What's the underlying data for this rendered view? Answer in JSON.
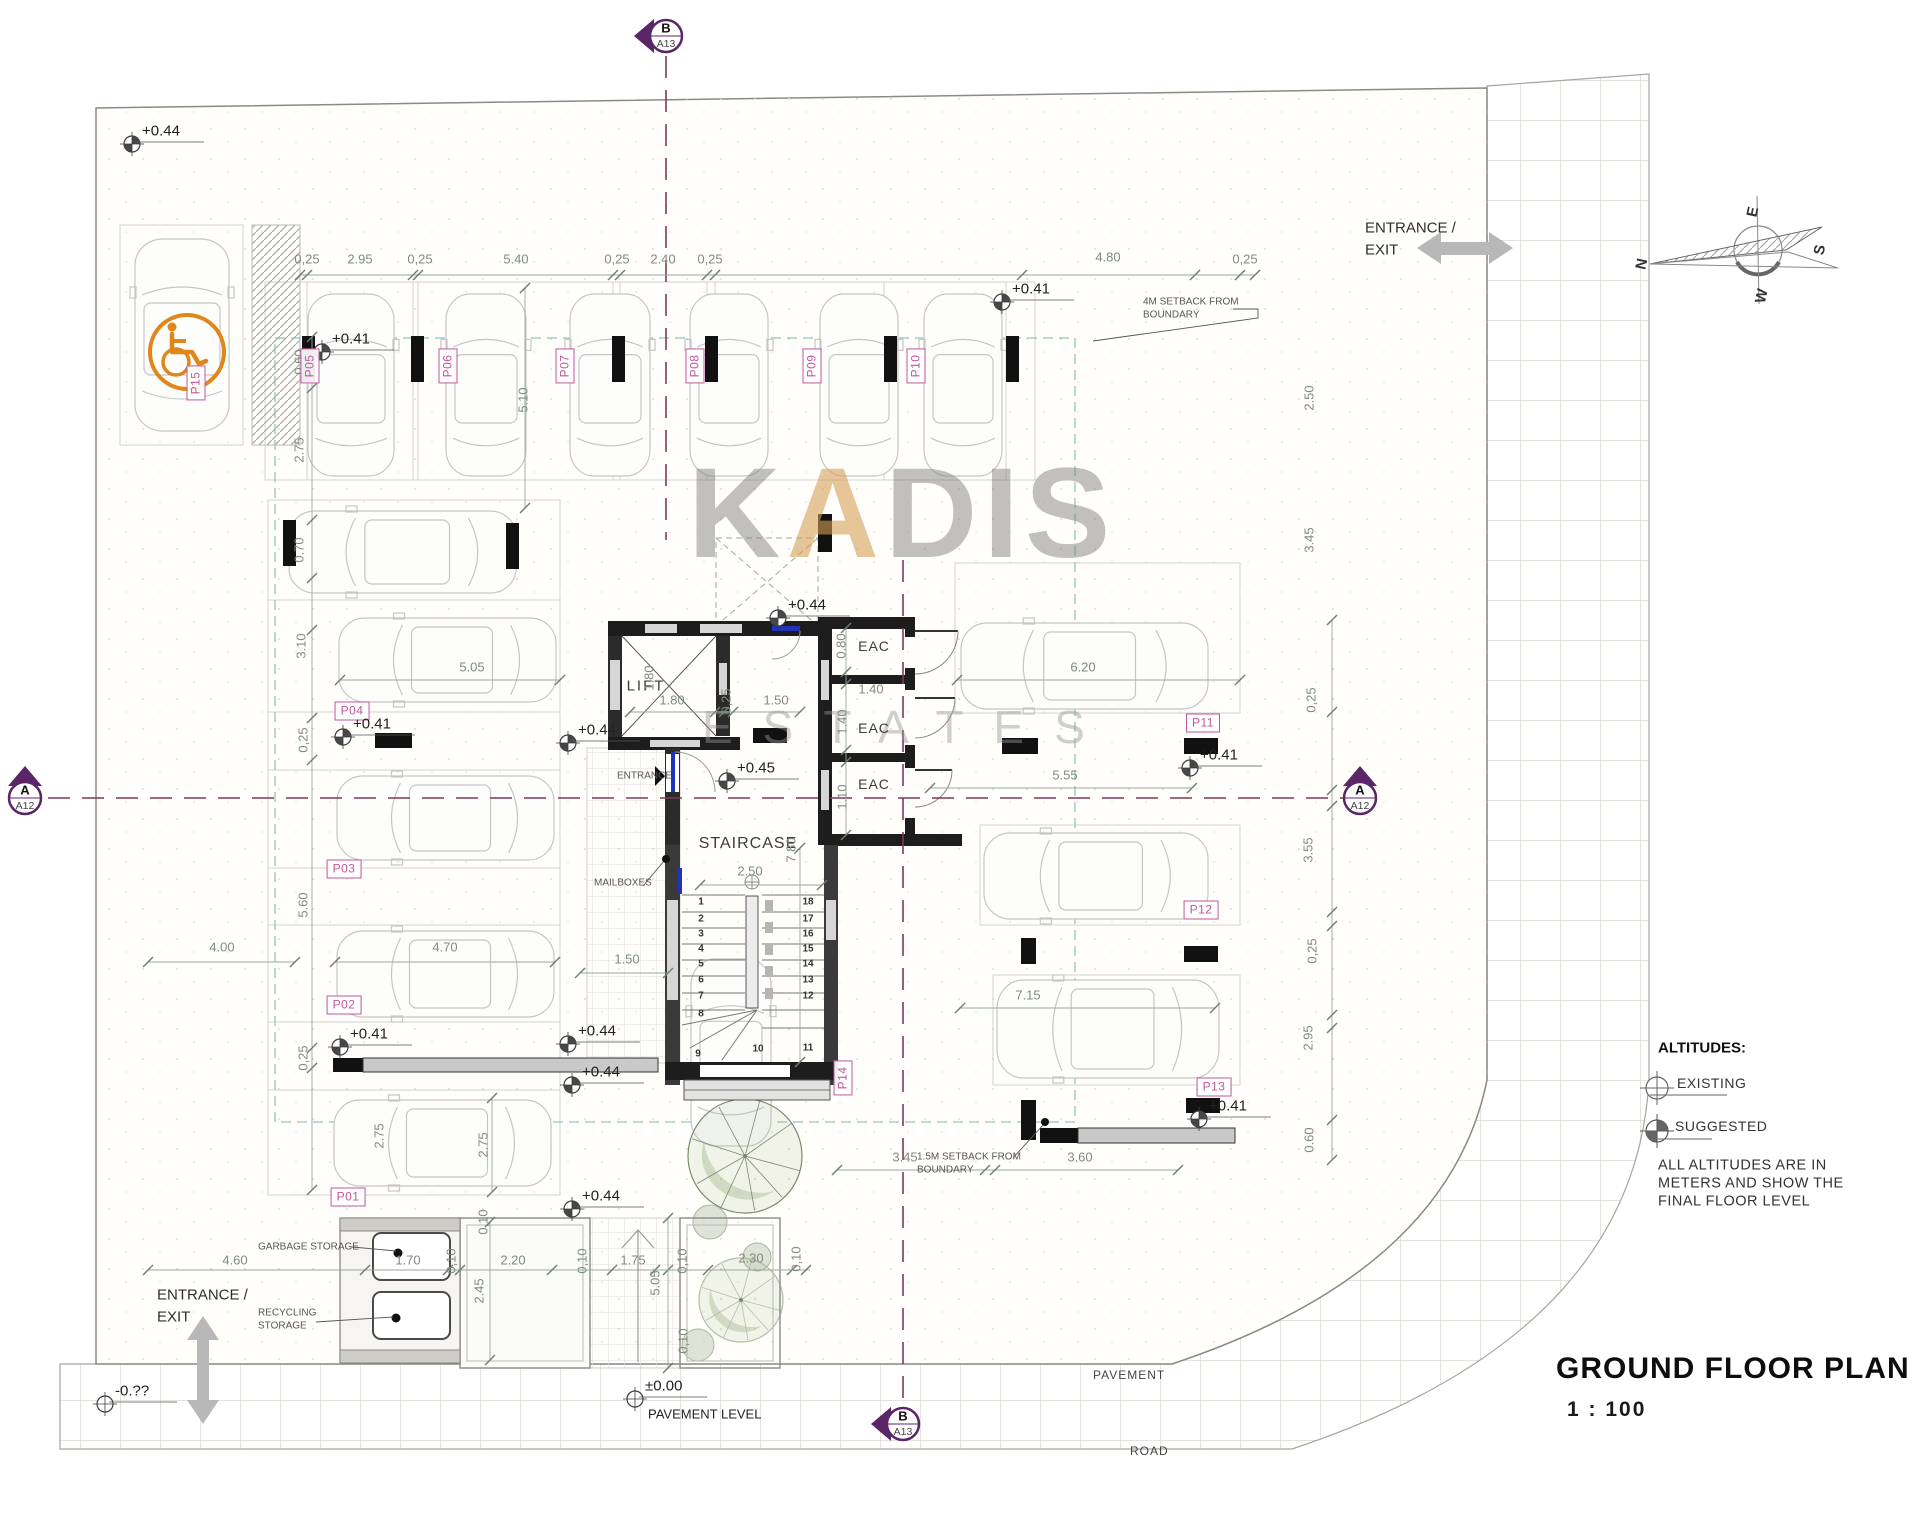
{
  "title": {
    "name": "GROUND FLOOR PLAN",
    "scale": "1 : 100"
  },
  "watermark": {
    "part1": "K",
    "part2": "A",
    "part3": "DIS",
    "line2": "ESTATES"
  },
  "compass": {
    "n": "N",
    "e": "E",
    "s": "S",
    "w": "W"
  },
  "legend": {
    "heading": "ALTITUDES:",
    "existing": "EXISTING",
    "suggested": "SUGGESTED",
    "note": [
      "ALL ALTITUDES ARE IN",
      "METERS AND SHOW THE",
      "FINAL FLOOR LEVEL"
    ]
  },
  "pavement_level_label": "PAVEMENT LEVEL",
  "section_markers": [
    {
      "top": "B",
      "bottom": "A13",
      "x": 666,
      "y": 36,
      "dir": "left"
    },
    {
      "top": "B",
      "bottom": "A13",
      "x": 903,
      "y": 1424,
      "dir": "left"
    },
    {
      "top": "A",
      "bottom": "A12",
      "x": 25,
      "y": 798,
      "dir": "up"
    },
    {
      "top": "A",
      "bottom": "A12",
      "x": 1360,
      "y": 798,
      "dir": "up"
    }
  ],
  "texts": [
    {
      "t": "LIFT",
      "x": 646,
      "y": 686,
      "s": 15,
      "ls": 2
    },
    {
      "t": "STAIRCASE",
      "x": 748,
      "y": 844,
      "s": 16,
      "ls": 1
    },
    {
      "t": "EAC",
      "x": 874,
      "y": 646,
      "s": 14,
      "ls": 1
    },
    {
      "t": "EAC",
      "x": 874,
      "y": 728,
      "s": 14,
      "ls": 1
    },
    {
      "t": "EAC",
      "x": 874,
      "y": 784,
      "s": 14,
      "ls": 1
    },
    {
      "t": "ENTRANCE",
      "x": 617,
      "y": 776,
      "s": 10,
      "a": "l",
      "c": "#555"
    },
    {
      "t": "MAILBOXES",
      "x": 594,
      "y": 883,
      "s": 10,
      "a": "l",
      "c": "#555"
    },
    {
      "t": "GARBAGE STORAGE",
      "x": 258,
      "y": 1247,
      "s": 10,
      "a": "l",
      "c": "#555"
    },
    {
      "t": "RECYCLING",
      "x": 258,
      "y": 1313,
      "s": 10,
      "a": "l",
      "c": "#555"
    },
    {
      "t": "STORAGE",
      "x": 258,
      "y": 1326,
      "s": 10,
      "a": "l",
      "c": "#555"
    },
    {
      "t": "4M SETBACK FROM",
      "x": 1143,
      "y": 302,
      "s": 10,
      "a": "l",
      "c": "#555"
    },
    {
      "t": "BOUNDARY",
      "x": 1143,
      "y": 315,
      "s": 10,
      "a": "l",
      "c": "#555"
    },
    {
      "t": "1.5M SETBACK FROM",
      "x": 917,
      "y": 1157,
      "s": 10,
      "a": "l",
      "c": "#555"
    },
    {
      "t": "BOUNDARY",
      "x": 917,
      "y": 1170,
      "s": 10,
      "a": "l",
      "c": "#555"
    },
    {
      "t": "PAVEMENT",
      "x": 1093,
      "y": 1376,
      "s": 12,
      "a": "l",
      "c": "#444",
      "ls": 1
    },
    {
      "t": "ROAD",
      "x": 1130,
      "y": 1452,
      "s": 12,
      "a": "l",
      "c": "#444",
      "ls": 1
    },
    {
      "t": "ENTRANCE /",
      "x": 1365,
      "y": 228,
      "s": 15,
      "a": "l",
      "c": "#2e2e2e"
    },
    {
      "t": "EXIT",
      "x": 1365,
      "y": 250,
      "s": 15,
      "a": "l",
      "c": "#2e2e2e"
    },
    {
      "t": "ENTRANCE /",
      "x": 157,
      "y": 1295,
      "s": 15,
      "a": "l",
      "c": "#2e2e2e"
    },
    {
      "t": "EXIT",
      "x": 157,
      "y": 1317,
      "s": 15,
      "a": "l",
      "c": "#2e2e2e"
    }
  ],
  "dims": [
    [
      "0,25",
      307,
      260,
      0
    ],
    [
      "2.95",
      360,
      260,
      0
    ],
    [
      "0,25",
      420,
      260,
      0
    ],
    [
      "5.40",
      516,
      260,
      0
    ],
    [
      "0,25",
      617,
      260,
      0
    ],
    [
      "2.40",
      663,
      260,
      0
    ],
    [
      "0,25",
      710,
      260,
      0
    ],
    [
      "4.80",
      1108,
      258,
      0
    ],
    [
      "0,25",
      1245,
      260,
      0
    ],
    [
      "0.60",
      300,
      362,
      1
    ],
    [
      "2.75",
      300,
      450,
      1
    ],
    [
      "0.70",
      300,
      550,
      1
    ],
    [
      "3.10",
      302,
      646,
      1
    ],
    [
      "0,25",
      304,
      740,
      1
    ],
    [
      "5.60",
      304,
      905,
      1
    ],
    [
      "0,25",
      304,
      1058,
      1
    ],
    [
      "2.50",
      1310,
      398,
      1
    ],
    [
      "3.45",
      1310,
      540,
      1
    ],
    [
      "0,25",
      1312,
      700,
      1
    ],
    [
      "3.55",
      1309,
      850,
      1
    ],
    [
      "0,25",
      1313,
      951,
      1
    ],
    [
      "2.95",
      1309,
      1038,
      1
    ],
    [
      "0.60",
      1310,
      1140,
      1
    ],
    [
      "4.60",
      235,
      1261,
      0
    ],
    [
      "1.70",
      408,
      1261,
      0
    ],
    [
      "0,10",
      452,
      1261,
      1
    ],
    [
      "2.20",
      513,
      1261,
      0
    ],
    [
      "0,10",
      583,
      1261,
      1
    ],
    [
      "1.75",
      633,
      1261,
      0
    ],
    [
      "0,10",
      683,
      1261,
      1
    ],
    [
      "2.30",
      751,
      1259,
      0
    ],
    [
      "0,10",
      797,
      1259,
      1
    ],
    [
      "5.05",
      472,
      668,
      0
    ],
    [
      "5.10",
      524,
      400,
      1
    ],
    [
      "4.00",
      222,
      948,
      0
    ],
    [
      "4.70",
      445,
      948,
      0
    ],
    [
      "1.50",
      627,
      960,
      0
    ],
    [
      "6.20",
      1083,
      668,
      0
    ],
    [
      "5.55",
      1065,
      776,
      0
    ],
    [
      "7.15",
      1028,
      996,
      0
    ],
    [
      "2.50",
      750,
      872,
      0
    ],
    [
      "1.80",
      672,
      701,
      0
    ],
    [
      "0,25",
      727,
      701,
      1
    ],
    [
      "1.50",
      776,
      701,
      0
    ],
    [
      "1.80",
      650,
      678,
      1
    ],
    [
      "0.80",
      842,
      646,
      1
    ],
    [
      "1.40",
      871,
      690,
      0
    ],
    [
      "1.40",
      843,
      722,
      1
    ],
    [
      "1.10",
      843,
      797,
      1
    ],
    [
      "7.80",
      792,
      850,
      1
    ],
    [
      "2.75",
      484,
      1145,
      1
    ],
    [
      "2.45",
      480,
      1291,
      1
    ],
    [
      "0,10",
      484,
      1222,
      1
    ],
    [
      "5.05",
      656,
      1283,
      1
    ],
    [
      "0,10",
      684,
      1341,
      1
    ],
    [
      "3.45",
      905,
      1158,
      0
    ],
    [
      "3.60",
      1080,
      1158,
      0
    ],
    [
      "2.75",
      380,
      1136,
      1
    ]
  ],
  "parking_labels": [
    [
      "P01",
      348,
      1197,
      0
    ],
    [
      "P02",
      344,
      1005,
      0
    ],
    [
      "P03",
      344,
      869,
      0
    ],
    [
      "P04",
      352,
      711,
      0
    ],
    [
      "P05",
      310,
      366,
      1
    ],
    [
      "P06",
      448,
      366,
      1
    ],
    [
      "P07",
      565,
      366,
      1
    ],
    [
      "P08",
      695,
      366,
      1
    ],
    [
      "P09",
      812,
      366,
      1
    ],
    [
      "P10",
      916,
      366,
      1
    ],
    [
      "P11",
      1203,
      723,
      0
    ],
    [
      "P12",
      1201,
      910,
      0
    ],
    [
      "P13",
      1214,
      1087,
      0
    ],
    [
      "P14",
      843,
      1078,
      1
    ],
    [
      "P15",
      196,
      383,
      1
    ]
  ],
  "stair_numbers": [
    [
      "1",
      701,
      902
    ],
    [
      "2",
      701,
      919
    ],
    [
      "3",
      701,
      934
    ],
    [
      "4",
      701,
      949
    ],
    [
      "5",
      701,
      964
    ],
    [
      "6",
      701,
      980
    ],
    [
      "7",
      701,
      996
    ],
    [
      "8",
      701,
      1014
    ],
    [
      "9",
      698,
      1054
    ],
    [
      "18",
      808,
      902
    ],
    [
      "17",
      808,
      919
    ],
    [
      "16",
      808,
      934
    ],
    [
      "15",
      808,
      949
    ],
    [
      "14",
      808,
      964
    ],
    [
      "13",
      808,
      980
    ],
    [
      "12",
      808,
      996
    ],
    [
      "11",
      808,
      1048
    ],
    [
      "10",
      758,
      1049
    ]
  ],
  "altitudes": [
    [
      "+0.44",
      132,
      144,
      "s"
    ],
    [
      "+0.41",
      322,
      352,
      "s"
    ],
    [
      "+0.41",
      1002,
      302,
      "s"
    ],
    [
      "+0.41",
      343,
      737,
      "s"
    ],
    [
      "+0.41",
      340,
      1047,
      "s"
    ],
    [
      "+0.41",
      1190,
      768,
      "s"
    ],
    [
      "+0.41",
      1199,
      1119,
      "s"
    ],
    [
      "+0.44",
      778,
      618,
      "s"
    ],
    [
      "+0.44",
      568,
      743,
      "s"
    ],
    [
      "+0.45",
      727,
      781,
      "s"
    ],
    [
      "+0.44",
      568,
      1044,
      "s"
    ],
    [
      "+0.44",
      572,
      1085,
      "s"
    ],
    [
      "+0.44",
      572,
      1209,
      "s"
    ],
    [
      "±0.00",
      635,
      1399,
      "e"
    ],
    [
      "-0.??",
      105,
      1404,
      "e"
    ]
  ],
  "dim_chains": [
    {
      "x1": 300,
      "y1": 275,
      "x2": 1255,
      "y2": 275,
      "ticks": [
        300,
        307,
        413,
        418,
        613,
        620,
        707,
        715,
        1022,
        1195,
        1240,
        1255
      ]
    },
    {
      "x1": 312,
      "y1": 337,
      "x2": 312,
      "y2": 1190,
      "ticks": [
        337,
        388,
        520,
        578,
        630,
        718,
        760,
        1048,
        1068,
        1190
      ]
    },
    {
      "x1": 1332,
      "y1": 620,
      "x2": 1332,
      "y2": 1160,
      "ticks": [
        620,
        712,
        790,
        806,
        912,
        926,
        1015,
        1028,
        1120,
        1160
      ]
    },
    {
      "x1": 148,
      "y1": 1270,
      "x2": 810,
      "y2": 1270,
      "ticks": [
        148,
        365,
        448,
        460,
        552,
        612,
        655,
        668,
        708,
        792,
        806
      ]
    },
    {
      "x1": 340,
      "y1": 680,
      "x2": 560,
      "y2": 680,
      "ticks": [
        340,
        560
      ]
    },
    {
      "x1": 525,
      "y1": 288,
      "x2": 525,
      "y2": 508,
      "ticks": [
        288,
        508
      ]
    },
    {
      "x1": 148,
      "y1": 962,
      "x2": 295,
      "y2": 962,
      "ticks": [
        148,
        295
      ]
    },
    {
      "x1": 335,
      "y1": 962,
      "x2": 555,
      "y2": 962,
      "ticks": [
        335,
        555
      ]
    },
    {
      "x1": 580,
      "y1": 973,
      "x2": 668,
      "y2": 973,
      "ticks": [
        580,
        668
      ]
    },
    {
      "x1": 957,
      "y1": 680,
      "x2": 1240,
      "y2": 680,
      "ticks": [
        957,
        1240
      ]
    },
    {
      "x1": 930,
      "y1": 788,
      "x2": 1192,
      "y2": 788,
      "ticks": [
        930,
        1192
      ]
    },
    {
      "x1": 960,
      "y1": 1008,
      "x2": 1215,
      "y2": 1008,
      "ticks": [
        960,
        1215
      ]
    },
    {
      "x1": 700,
      "y1": 885,
      "x2": 822,
      "y2": 885,
      "ticks": [
        700,
        822
      ]
    },
    {
      "x1": 630,
      "y1": 712,
      "x2": 800,
      "y2": 712,
      "ticks": [
        630,
        715,
        724,
        733,
        800
      ]
    },
    {
      "x1": 846,
      "y1": 628,
      "x2": 846,
      "y2": 835,
      "ticks": [
        628,
        672,
        684,
        750,
        762,
        835
      ]
    },
    {
      "x1": 837,
      "y1": 1170,
      "x2": 1178,
      "y2": 1170,
      "ticks": [
        837,
        985,
        995,
        1178
      ]
    },
    {
      "x1": 492,
      "y1": 1098,
      "x2": 492,
      "y2": 1192,
      "ticks": [
        1098,
        1192
      ]
    },
    {
      "x1": 490,
      "y1": 1222,
      "x2": 490,
      "y2": 1360,
      "ticks": [
        1222,
        1360
      ]
    },
    {
      "x1": 668,
      "y1": 1218,
      "x2": 668,
      "y2": 1368,
      "ticks": [
        1218,
        1368
      ]
    },
    {
      "x1": 800,
      "y1": 848,
      "x2": 800,
      "y2": 1062,
      "ticks": [
        848,
        1062
      ]
    }
  ],
  "cars": [
    {
      "x": 132,
      "y": 235,
      "w": 100,
      "h": 200,
      "o": "v"
    },
    {
      "x": 305,
      "y": 290,
      "w": 92,
      "h": 190,
      "o": "v"
    },
    {
      "x": 443,
      "y": 290,
      "w": 86,
      "h": 190,
      "o": "v"
    },
    {
      "x": 567,
      "y": 290,
      "w": 86,
      "h": 190,
      "o": "v"
    },
    {
      "x": 687,
      "y": 290,
      "w": 84,
      "h": 190,
      "o": "v"
    },
    {
      "x": 817,
      "y": 290,
      "w": 84,
      "h": 190,
      "o": "v"
    },
    {
      "x": 921,
      "y": 290,
      "w": 84,
      "h": 190,
      "o": "v"
    },
    {
      "x": 285,
      "y": 508,
      "w": 235,
      "h": 88,
      "o": "h"
    },
    {
      "x": 335,
      "y": 615,
      "w": 225,
      "h": 90,
      "o": "h"
    },
    {
      "x": 333,
      "y": 773,
      "w": 225,
      "h": 90,
      "o": "h"
    },
    {
      "x": 333,
      "y": 928,
      "w": 225,
      "h": 92,
      "o": "h"
    },
    {
      "x": 330,
      "y": 1097,
      "w": 225,
      "h": 92,
      "o": "h"
    },
    {
      "x": 957,
      "y": 620,
      "w": 255,
      "h": 92,
      "o": "h"
    },
    {
      "x": 980,
      "y": 830,
      "w": 232,
      "h": 92,
      "o": "h"
    },
    {
      "x": 993,
      "y": 977,
      "w": 230,
      "h": 104,
      "o": "h"
    },
    {
      "x": 688,
      "y": 955,
      "w": 86,
      "h": 195,
      "o": "v"
    }
  ],
  "trees": [
    {
      "x": 522,
      "y": 1288,
      "r": 54
    },
    {
      "x": 745,
      "y": 1156,
      "r": 57
    },
    {
      "x": 741,
      "y": 1300,
      "r": 42,
      "f": 1
    },
    {
      "x": 710,
      "y": 1222,
      "r": 17,
      "b": 1
    },
    {
      "x": 757,
      "y": 1257,
      "r": 14,
      "b": 1
    },
    {
      "x": 698,
      "y": 1345,
      "r": 16,
      "b": 1
    }
  ],
  "colors": {
    "parking_label": "#c0579b",
    "section_marker": "#5a2668",
    "centerline": "#7c3a5a",
    "setback": "#8fc4c4",
    "handicap": "#e0861a",
    "dimension": "#7f8c7f",
    "door": "#2233bb"
  }
}
